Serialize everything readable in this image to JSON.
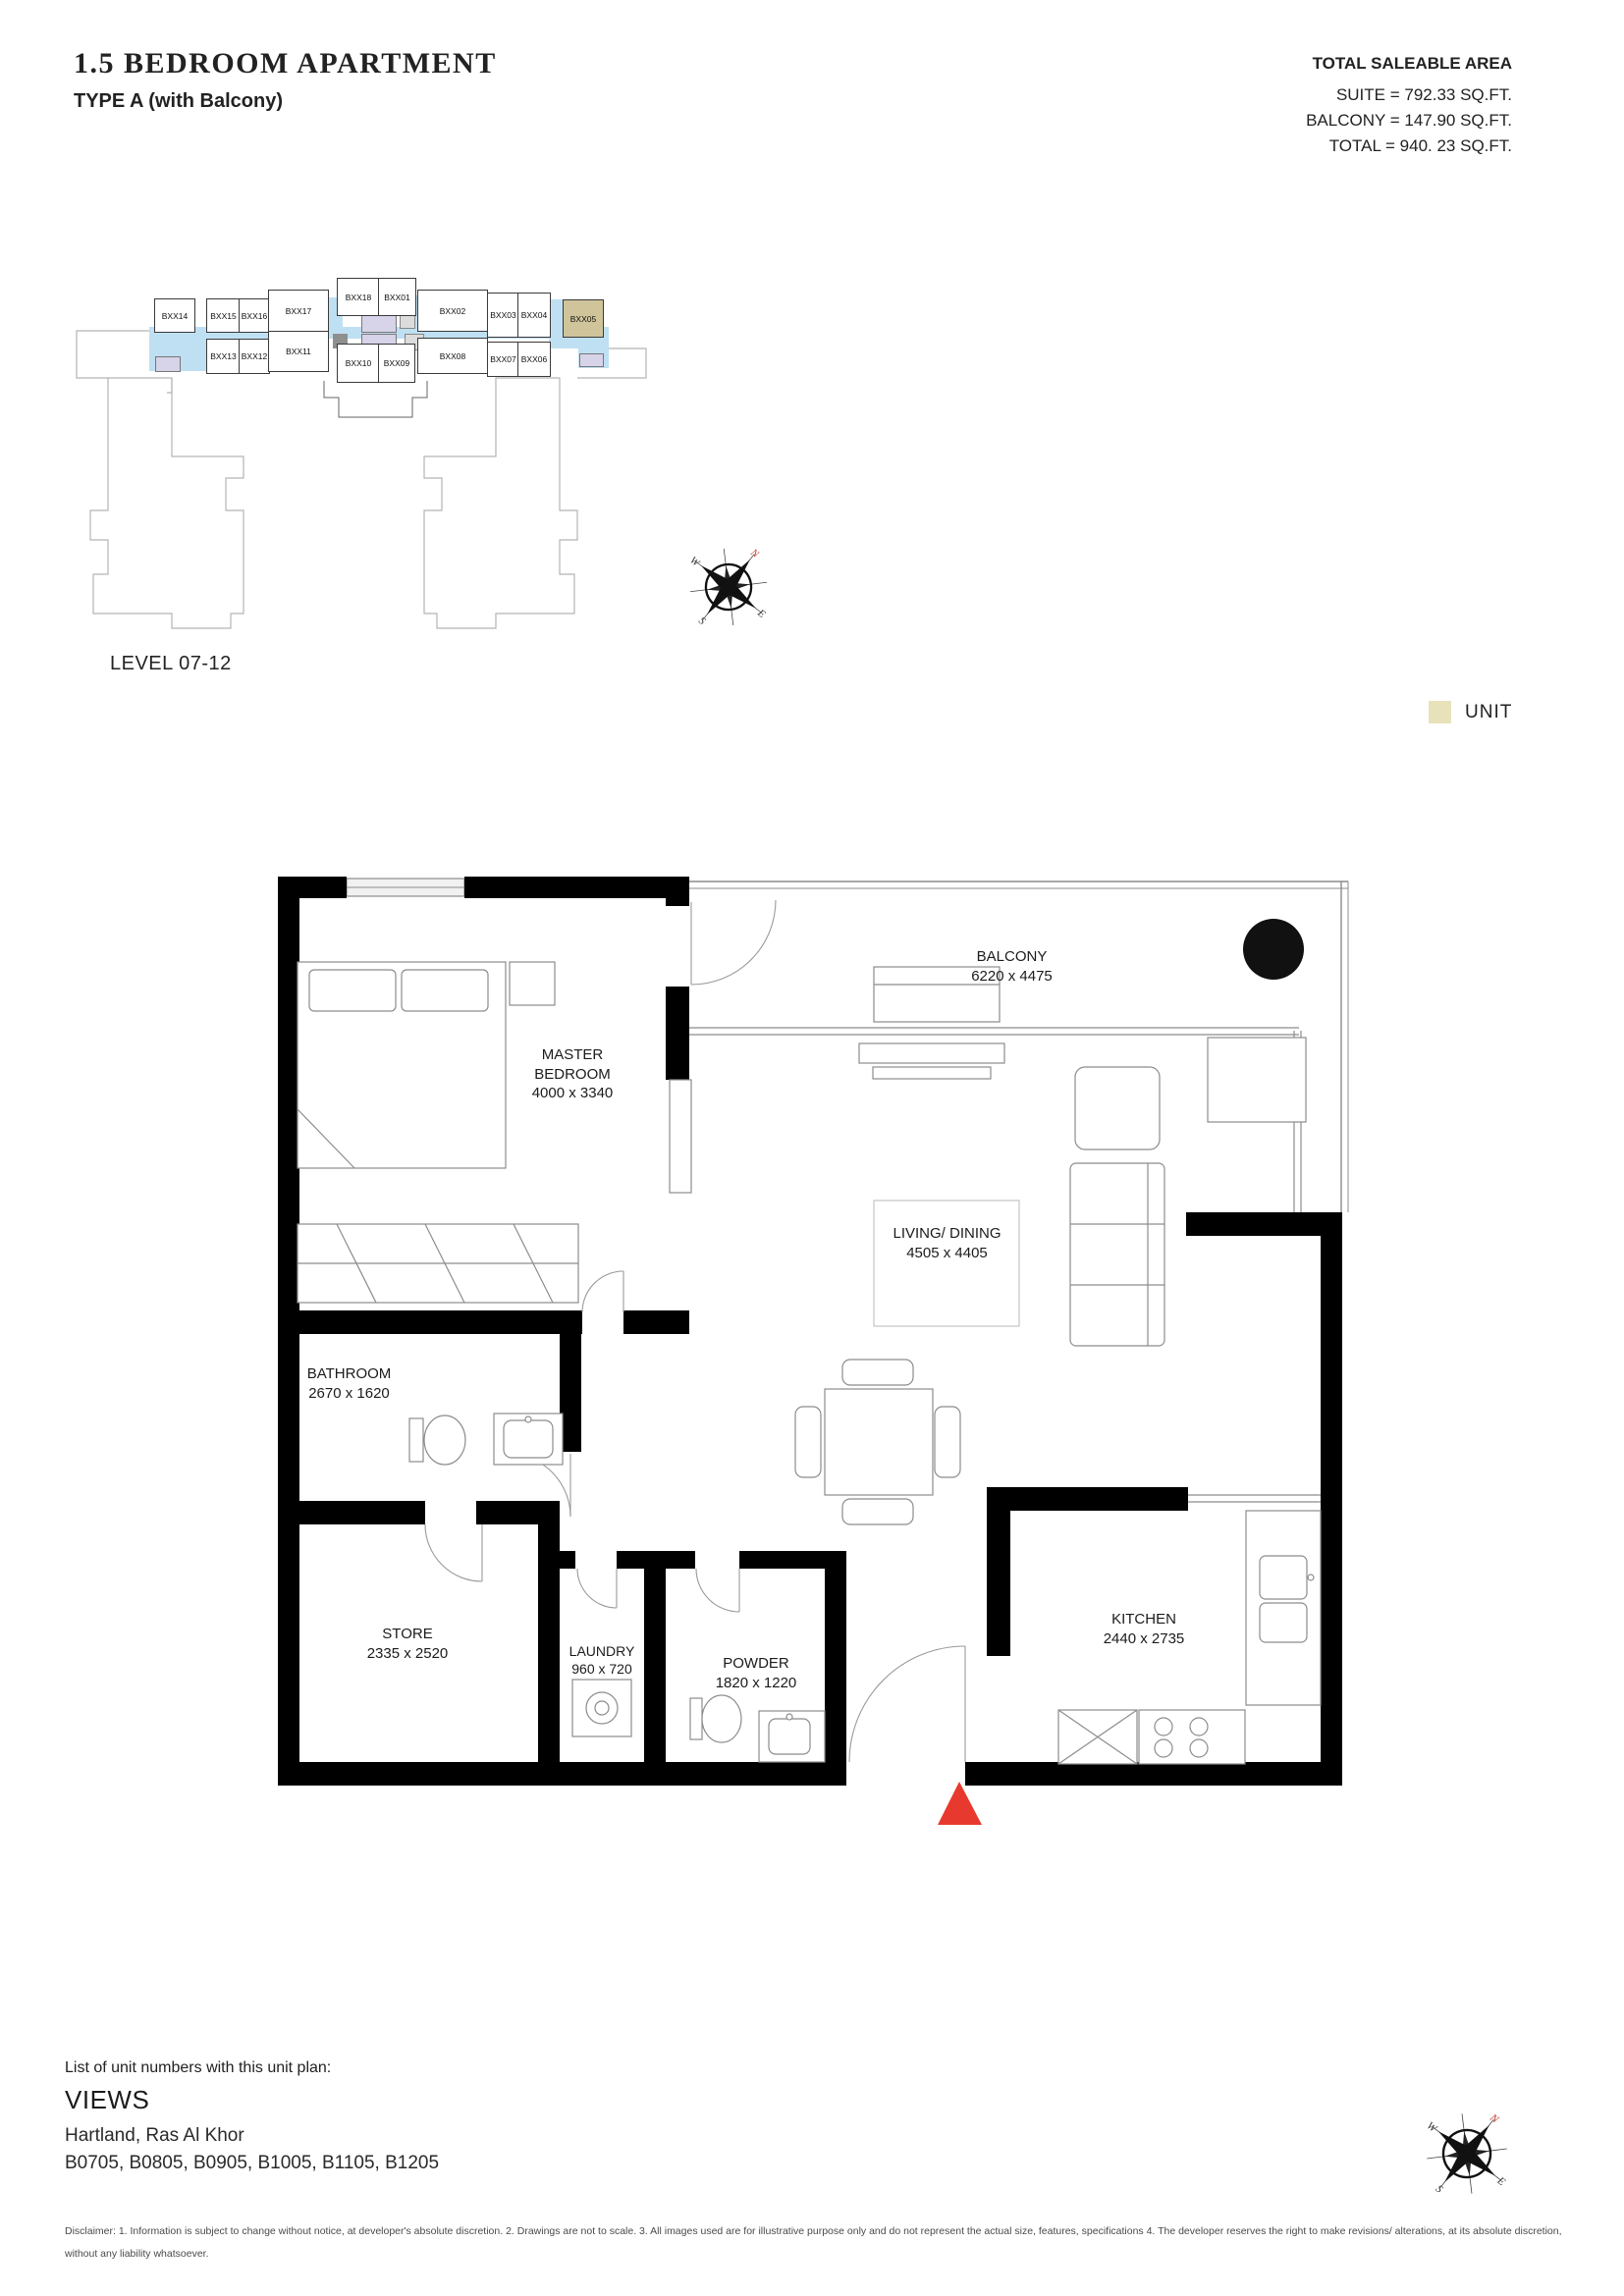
{
  "header": {
    "title": "1.5 BEDROOM APARTMENT",
    "subtitle": "TYPE A (with Balcony)",
    "area": {
      "heading": "TOTAL SALEABLE AREA",
      "suite": "SUITE = 792.33 SQ.FT.",
      "balcony": "BALCONY = 147.90 SQ.FT.",
      "total": "TOTAL = 940. 23 SQ.FT."
    }
  },
  "key_plan": {
    "level_label": "LEVEL 07-12",
    "highlighted_unit": "BXX05",
    "colors": {
      "highlight": "#cfc49a",
      "corridor": "#bfe0f2",
      "core": "#d7d3e8"
    },
    "units": [
      {
        "label": "BXX18"
      },
      {
        "label": "BXX01"
      },
      {
        "label": "BXX14"
      },
      {
        "label": "BXX15"
      },
      {
        "label": "BXX16"
      },
      {
        "label": "BXX17"
      },
      {
        "label": "BXX02"
      },
      {
        "label": "BXX03"
      },
      {
        "label": "BXX04"
      },
      {
        "label": "BXX05"
      },
      {
        "label": "BXX13"
      },
      {
        "label": "BXX12"
      },
      {
        "label": "BXX11"
      },
      {
        "label": "BXX10"
      },
      {
        "label": "BXX09"
      },
      {
        "label": "BXX08"
      },
      {
        "label": "BXX07"
      },
      {
        "label": "BXX06"
      }
    ]
  },
  "legend": {
    "label": "UNIT",
    "swatch": "#e8e2ba"
  },
  "compass": {
    "n": "N",
    "e": "E",
    "s": "S",
    "w": "W",
    "north_color": "#c0392b"
  },
  "floor_plan": {
    "entrance_marker_color": "#e8392f",
    "rooms": {
      "master": {
        "name": "MASTER BEDROOM",
        "dims": "4000 x 3340"
      },
      "balcony": {
        "name": "BALCONY",
        "dims": "6220 x 4475"
      },
      "living": {
        "name": "LIVING/ DINING",
        "dims": "4505 x 4405"
      },
      "bathroom": {
        "name": "BATHROOM",
        "dims": "2670 x 1620"
      },
      "store": {
        "name": "STORE",
        "dims": "2335 x 2520"
      },
      "laundry": {
        "name": "LAUNDRY",
        "dims": "960 x 720"
      },
      "powder": {
        "name": "POWDER",
        "dims": "1820 x 1220"
      },
      "kitchen": {
        "name": "KITCHEN",
        "dims": "2440 x 2735"
      }
    }
  },
  "footer": {
    "list_intro": "List of unit numbers with this unit plan:",
    "project": "VIEWS",
    "location": "Hartland, Ras Al Khor",
    "unit_numbers": "B0705, B0805, B0905, B1005, B1105, B1205",
    "disclaimer": "Disclaimer: 1. Information is subject to change without notice, at developer's absolute discretion. 2. Drawings are not to scale. 3. All images used are for illustrative purpose only and do not represent the actual size, features, specifications 4. The developer reserves the right to make revisions/ alterations, at its absolute discretion, without any liability whatsoever."
  }
}
